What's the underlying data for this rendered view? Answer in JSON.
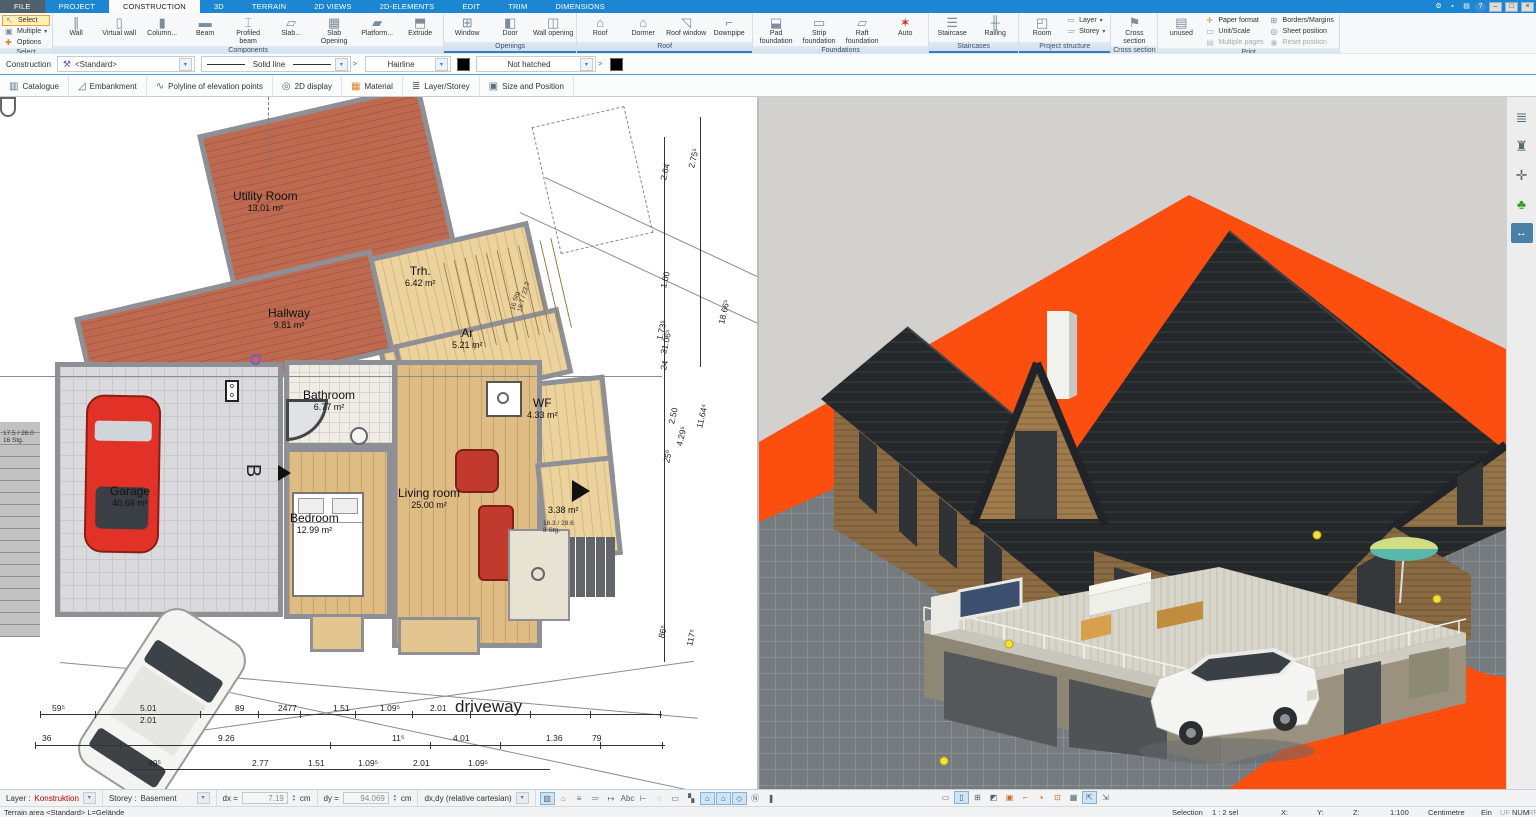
{
  "colors": {
    "accent_blue": "#1c86d2",
    "terrain_orange": "#fb4e0f",
    "roof_dark": "#24282b",
    "wood_wall": "#8d6c44",
    "selection_red": "#c00000",
    "group_band_border": "#2f7fc1"
  },
  "window": {
    "titlebar_icons": [
      {
        "name": "settings-gear-icon",
        "glyph": "⚙"
      },
      {
        "name": "lock-icon",
        "glyph": "▪"
      },
      {
        "name": "print-icon",
        "glyph": "▤"
      },
      {
        "name": "help-icon",
        "glyph": "?"
      }
    ],
    "window_controls": [
      {
        "name": "minimize-button",
        "glyph": "–"
      },
      {
        "name": "restore-button",
        "glyph": "□"
      },
      {
        "name": "close-button",
        "glyph": "×"
      }
    ]
  },
  "tabs": [
    {
      "label": "FILE",
      "file": true
    },
    {
      "label": "PROJECT"
    },
    {
      "label": "CONSTRUCTION",
      "active": true
    },
    {
      "label": "3D"
    },
    {
      "label": "TERRAIN"
    },
    {
      "label": "2D VIEWS"
    },
    {
      "label": "2D-ELEMENTS"
    },
    {
      "label": "EDIT"
    },
    {
      "label": "TRIM"
    },
    {
      "label": "DIMENSIONS"
    }
  ],
  "ribbon": {
    "groups": [
      {
        "label": "Select",
        "buttons": [
          {
            "label": "Select",
            "icon": "select-cursor-icon",
            "glyph": "↖",
            "type": "small",
            "highlighted": true
          },
          {
            "label": "Multiple",
            "icon": "multiple-select-icon",
            "glyph": "▣",
            "type": "small",
            "arrow": true
          },
          {
            "label": "Options",
            "icon": "options-plus-icon",
            "glyph": "✚",
            "type": "small",
            "color": "#e07f2a"
          }
        ]
      },
      {
        "label": "Components",
        "buttons": [
          {
            "label": "Wall",
            "icon": "wall-icon",
            "glyph": "∥"
          },
          {
            "label": "Virtual wall",
            "icon": "virtual-wall-icon",
            "glyph": "▯"
          },
          {
            "label": "Column...",
            "icon": "column-icon",
            "glyph": "▮"
          },
          {
            "label": "Beam",
            "icon": "beam-icon",
            "glyph": "▬"
          },
          {
            "label": "Profiled beam",
            "icon": "profiled-beam-icon",
            "glyph": "⌶"
          },
          {
            "label": "Slab...",
            "icon": "slab-icon",
            "glyph": "▱"
          },
          {
            "label": "Slab Opening",
            "icon": "slab-opening-icon",
            "glyph": "▦"
          },
          {
            "label": "Platform...",
            "icon": "platform-icon",
            "glyph": "▰"
          },
          {
            "label": "Extrude",
            "icon": "extrude-icon",
            "glyph": "⬒"
          }
        ]
      },
      {
        "label": "Openings",
        "buttons": [
          {
            "label": "Window",
            "icon": "window-icon",
            "glyph": "⊞"
          },
          {
            "label": "Door",
            "icon": "door-icon",
            "glyph": "◧"
          },
          {
            "label": "Wall opening",
            "icon": "wall-opening-icon",
            "glyph": "◫"
          }
        ]
      },
      {
        "label": "Roof",
        "buttons": [
          {
            "label": "Roof",
            "icon": "roof-icon",
            "glyph": "⌂"
          },
          {
            "label": "Dormer",
            "icon": "dormer-icon",
            "glyph": "⌂"
          },
          {
            "label": "Roof window",
            "icon": "roof-window-icon",
            "glyph": "◹"
          },
          {
            "label": "Downpipe",
            "icon": "downpipe-icon",
            "glyph": "⌐"
          }
        ]
      },
      {
        "label": "Foundations",
        "buttons": [
          {
            "label": "Pad foundation",
            "icon": "pad-foundation-icon",
            "glyph": "⬓"
          },
          {
            "label": "Strip foundation",
            "icon": "strip-foundation-icon",
            "glyph": "▭"
          },
          {
            "label": "Raft foundation",
            "icon": "raft-foundation-icon",
            "glyph": "▱"
          },
          {
            "label": "Auto",
            "icon": "auto-icon",
            "glyph": "✶",
            "color": "#c0392b"
          }
        ]
      },
      {
        "label": "Staircases",
        "buttons": [
          {
            "label": "Staircase",
            "icon": "staircase-icon",
            "glyph": "☰"
          },
          {
            "label": "Railing",
            "icon": "railing-icon",
            "glyph": "╫"
          }
        ]
      },
      {
        "label": "Project structure",
        "buttons": [
          {
            "label": "Room",
            "icon": "room-icon",
            "glyph": "◰"
          },
          {
            "label": "Layer",
            "icon": "layer-icon",
            "glyph": "≔",
            "type": "small",
            "arrow": true
          },
          {
            "label": "Storey",
            "icon": "storey-icon",
            "glyph": "≕",
            "type": "small",
            "arrow": true
          }
        ]
      },
      {
        "label": "Cross section",
        "buttons": [
          {
            "label": "Cross section",
            "icon": "cross-section-icon",
            "glyph": "⚑"
          }
        ]
      },
      {
        "label": "Print",
        "buttons": [
          {
            "label": "unused",
            "icon": "printer-icon",
            "glyph": "▤"
          },
          {
            "label": "Paper format",
            "icon": "paper-format-icon",
            "glyph": "✛",
            "type": "small",
            "color": "#e07f2a"
          },
          {
            "label": "Unit/Scale",
            "icon": "unit-scale-icon",
            "glyph": "▭",
            "type": "small"
          },
          {
            "label": "Multiple pages",
            "icon": "multiple-pages-icon",
            "glyph": "▤",
            "type": "small",
            "disabled": true
          },
          {
            "label": "Borders/Margins",
            "icon": "borders-margins-icon",
            "glyph": "⊞",
            "type": "small"
          },
          {
            "label": "Sheet position",
            "icon": "sheet-position-icon",
            "glyph": "◎",
            "type": "small"
          },
          {
            "label": "Reset position",
            "icon": "reset-position-icon",
            "glyph": "◉",
            "type": "small",
            "disabled": true,
            "color": "#e0a33e"
          }
        ]
      }
    ]
  },
  "properties_bar": {
    "construction_label": "Construction",
    "style_value": "<Standard>",
    "line_type_value": "Solid line",
    "line_width_value": "Hairline",
    "hatch_value": "Not hatched"
  },
  "tools_bar": [
    {
      "label": "Catalogue",
      "icon": "catalogue-icon",
      "glyph": "▥"
    },
    {
      "label": "Embankment",
      "icon": "embankment-icon",
      "glyph": "◿"
    },
    {
      "label": "Polyline of elevation points",
      "icon": "polyline-icon",
      "glyph": "∿"
    },
    {
      "label": "2D display",
      "icon": "2d-display-icon",
      "glyph": "◎"
    },
    {
      "label": "Material",
      "icon": "material-icon",
      "glyph": "▦",
      "mat": true
    },
    {
      "label": "Layer/Storey",
      "icon": "layer-storey-icon",
      "glyph": "≣"
    },
    {
      "label": "Size and Position",
      "icon": "size-position-icon",
      "glyph": "▣"
    }
  ],
  "plan": {
    "rooms": [
      {
        "name": "Utility Room",
        "area": "13.01 m²"
      },
      {
        "name": "Trh.",
        "area": "6.42 m²"
      },
      {
        "name": "Hallway",
        "area": "9.81 m²"
      },
      {
        "name": "Ar",
        "area": "5.21 m²"
      },
      {
        "name": "Bathroom",
        "area": "6.77 m²"
      },
      {
        "name": "WF",
        "area": "4.33 m²"
      },
      {
        "name": "Garage",
        "area": "40.69 m²"
      },
      {
        "name": "Bedroom",
        "area": "12.99 m²"
      },
      {
        "name": "Living room",
        "area": "25.00 m²"
      },
      {
        "name": "",
        "area": "3.38 m²"
      }
    ],
    "annotations": {
      "stair_top": "16 Stg\n18.7 / 23.2",
      "stair_r338": "16.3 / 28.6\n8 Stg.",
      "stair_left": "17.5 / 28.0\n16 Stg.",
      "driveway": "driveway",
      "section_marker": "B"
    },
    "dims": {
      "row1": [
        "59⁵",
        "5.01",
        "89",
        "2477",
        "1.51",
        "1.09⁵",
        "2.01"
      ],
      "row1b": "2.01",
      "row2": [
        "36",
        "9.26",
        "11⁵",
        "4.01",
        "1.36",
        "79"
      ],
      "row3": [
        "40⁵",
        "2.77",
        "1.51",
        "1.09⁵",
        "2.01",
        "1.09⁵"
      ],
      "right": [
        "2.75⁵",
        "2.64",
        "1.00",
        "31.06⁵",
        "1.73⁵",
        "24",
        "2.50",
        "18.66⁵",
        "11.64⁴",
        "25⁰",
        "4.29⁵",
        "86⁵",
        "117⁵"
      ]
    }
  },
  "view3d": {
    "description": "3D perspective of house with dark roof, wood cladding, terrace, white car, orange terrain"
  },
  "right_panel": [
    {
      "name": "layers-icon",
      "glyph": "≣"
    },
    {
      "name": "furniture-icon",
      "glyph": "♜"
    },
    {
      "name": "move-mode-icon",
      "glyph": "✛"
    },
    {
      "name": "plants-icon",
      "glyph": "♣",
      "cls": "tree"
    },
    {
      "name": "section-width-icon",
      "glyph": "↔",
      "cls": "blue"
    }
  ],
  "bottom_bar": {
    "layer_label": "Layer :",
    "layer_value": "Konstruktion",
    "storey_label": "Storey :",
    "storey_value": "Basement",
    "dx_label": "dx =",
    "dx_value": "7.19",
    "dx_unit": "cm",
    "dy_label": "dy =",
    "dy_value": "94.069",
    "dy_unit": "cm",
    "coord_mode": "dx,dy (relative cartesian)",
    "icons_2d": [
      {
        "name": "hatch-display-icon",
        "glyph": "▨",
        "active": true
      },
      {
        "name": "roof-color-icon",
        "glyph": "⌂",
        "orange": true
      },
      {
        "name": "line-weight-icon",
        "glyph": "≡"
      },
      {
        "name": "dashed-lines-icon",
        "glyph": "≕"
      },
      {
        "name": "dimension-style-icon",
        "glyph": "↦"
      },
      {
        "name": "text-style-icon",
        "glyph": "Abc"
      },
      {
        "name": "dimension-chain-icon",
        "glyph": "⊢"
      },
      {
        "name": "selection-ellipse-icon",
        "glyph": "◌"
      },
      {
        "name": "viewport-frame-icon",
        "glyph": "▭"
      },
      {
        "name": "corner-fill-icon",
        "glyph": "▚"
      },
      {
        "name": "roof-plan-icon",
        "glyph": "⌂",
        "active": true
      },
      {
        "name": "roof-3d-icon",
        "glyph": "⌂",
        "active": true
      },
      {
        "name": "slab-view-icon",
        "glyph": "◇",
        "active": true
      },
      {
        "name": "north-arrow-icon",
        "glyph": "Ⓝ"
      },
      {
        "name": "pointer-flag-icon",
        "glyph": "❚"
      }
    ],
    "icons_3d": [
      {
        "name": "measure-icon",
        "glyph": "▭"
      },
      {
        "name": "viewport-icon",
        "glyph": "▯",
        "active": true
      },
      {
        "name": "tile-windows-icon",
        "glyph": "⊞"
      },
      {
        "name": "render-quality-icon",
        "glyph": "◩"
      },
      {
        "name": "image-export-icon",
        "glyph": "▣",
        "orange": true
      },
      {
        "name": "section-view-icon",
        "glyph": "⌐",
        "orange": true
      },
      {
        "name": "light-icon",
        "glyph": "▪",
        "orange": true
      },
      {
        "name": "focus-icon",
        "glyph": "⊡",
        "orange": true
      },
      {
        "name": "grid-icon",
        "glyph": "▦"
      },
      {
        "name": "link-views-icon",
        "glyph": "⇱",
        "active": true
      },
      {
        "name": "swap-views-icon",
        "glyph": "⇲"
      }
    ]
  },
  "status_bar": {
    "left_text": "Terrain area <Standard> L=Gelände",
    "selection_label": "Selection",
    "selection_value": "1 : 2 sel",
    "x_label": "X:",
    "y_label": "Y:",
    "z_label": "Z:",
    "scale": "1:100",
    "unit": "Centimetre",
    "ein": "Ein",
    "flag_uf": "UF",
    "flag_num": "NUM",
    "flag_rf": "RF"
  }
}
